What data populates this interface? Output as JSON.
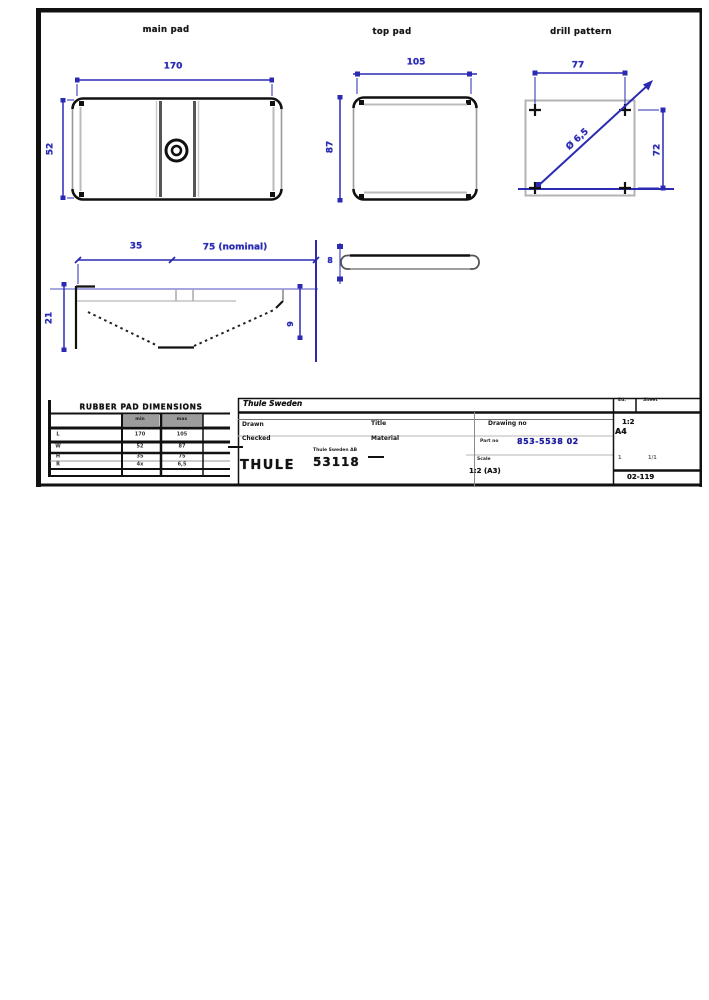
{
  "views": {
    "view1": {
      "label": "main pad",
      "dim_width": "170",
      "dim_height": "52"
    },
    "view2": {
      "label": "top pad",
      "dim_width": "105",
      "dim_height": "87"
    },
    "view3": {
      "label": "drill pattern",
      "dim_width": "77",
      "dim_height": "72",
      "dim_hole": "Ø 6,5"
    },
    "view4": {
      "dim_a": "35",
      "dim_b": "75 (nominal)",
      "dim_left": "21",
      "dim_right": "9"
    },
    "view5": {
      "dim_thickness": "8"
    }
  },
  "parts_table": {
    "header": "RUBBER PAD DIMENSIONS",
    "subcols": [
      "min",
      "max"
    ],
    "rows": [
      [
        "L",
        "170",
        "105"
      ],
      [
        "W",
        "52",
        "87"
      ],
      [
        "H",
        "35",
        "75"
      ],
      [
        "R",
        "4x",
        "6,5"
      ]
    ]
  },
  "title_block": {
    "header": "Thule Sweden",
    "drawn_label": "Drawn",
    "checked_label": "Checked",
    "title_label": "Title",
    "material_label": "Material",
    "drawing_no_label": "Drawing no",
    "part_no_label": "Part no",
    "drawing_no": "853-5538 02",
    "company": "THULE",
    "company_sub": "Thule Sweden AB",
    "company_code": "53118",
    "scale_label": "Scale",
    "scale_value": "1:2 (A3)",
    "ed_label": "Ed.",
    "sheet_label": "Sheet",
    "ratio": "1:2",
    "format": "A4",
    "sheet_left": "1",
    "sheet_right": "1/1",
    "rev": "02-119"
  },
  "colors": {
    "dimension_blue": "#2a2ab2",
    "outline_black": "#111111",
    "outline_gray": "#9a9a9a"
  }
}
